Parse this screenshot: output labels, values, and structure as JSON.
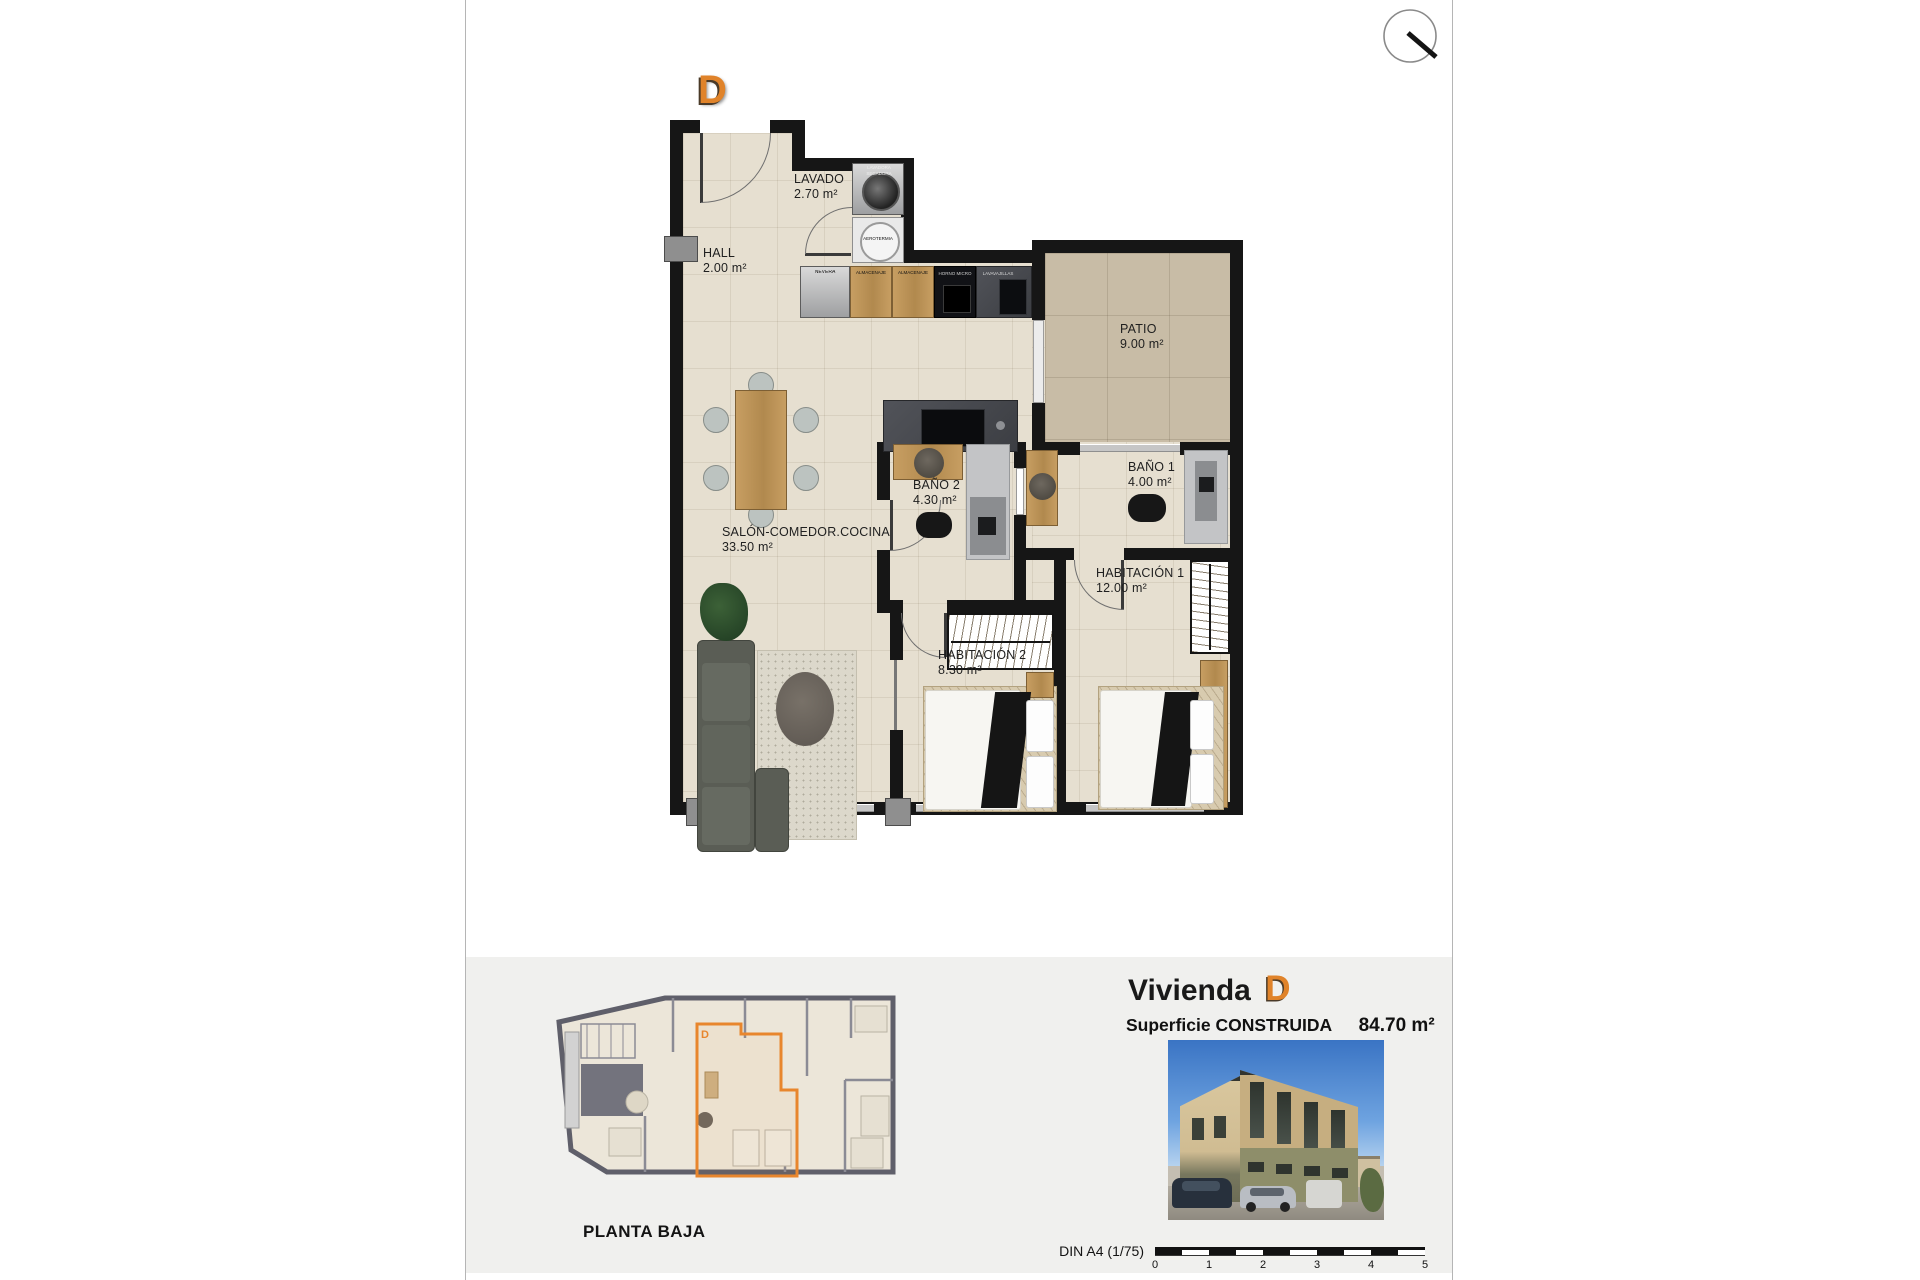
{
  "unit": {
    "letter": "D"
  },
  "floor_plan": {
    "rooms": [
      {
        "name": "HALL",
        "area": "2.00 m²"
      },
      {
        "name": "LAVADO",
        "area": "2.70 m²"
      },
      {
        "name": "PATIO",
        "area": "9.00 m²"
      },
      {
        "name": "SALÓN-COMEDOR.COCINA",
        "area": "33.50 m²"
      },
      {
        "name": "BAÑO 2",
        "area": "4.30 m²"
      },
      {
        "name": "BAÑO 1",
        "area": "4.00 m²"
      },
      {
        "name": "HABITACIÓN 1",
        "area": "12.00 m²"
      },
      {
        "name": "HABITACIÓN 2",
        "area": "8.30 m²"
      }
    ],
    "kitchen_units": [
      "NEVERA",
      "ALMACENAJE",
      "ALMACENAJE",
      "HORNO MICRO",
      "LAVAVAJILLAS"
    ],
    "laundry_units": [
      "LAVADORA SECADORA",
      "AEROTERMIA"
    ]
  },
  "footer": {
    "plan_title": "PLANTA BAJA",
    "vivienda_label": "Vivienda",
    "vivienda_letter": "D",
    "surface_label": "Superficie CONSTRUIDA",
    "surface_value": "84.70 m²",
    "scale_label": "DIN A4 (1/75)",
    "scale_ticks": [
      "0",
      "1",
      "2",
      "3",
      "4",
      "5"
    ],
    "mini_plan_unit_letter": "D"
  },
  "colors": {
    "accent": "#E0832A",
    "wall": "#161616",
    "floor": "#E6DFD0",
    "patio_floor": "#C8BCA6",
    "footer_bg": "#F0F0EE"
  },
  "icons": {
    "top_right": "compass-needle-icon"
  }
}
